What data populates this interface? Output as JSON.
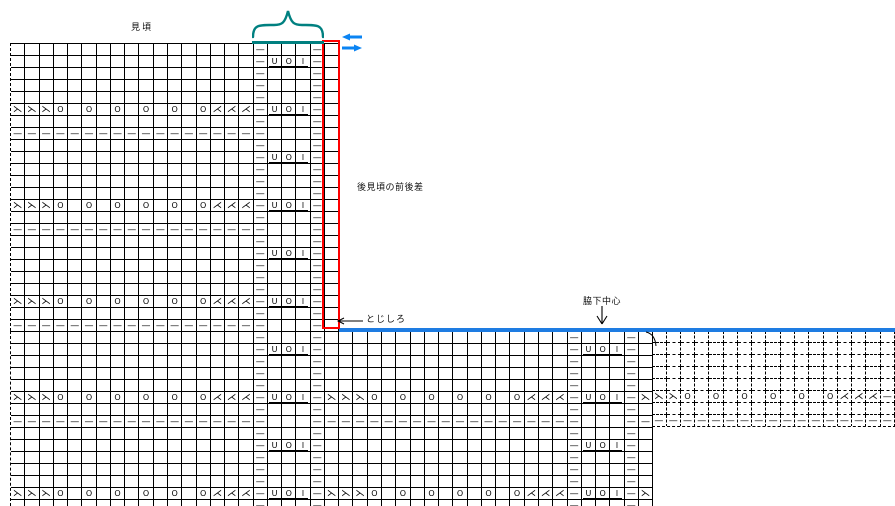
{
  "labels": {
    "migoro": "見頃",
    "back_difference": "後見頃の前後差",
    "tojishiro": "とじしろ",
    "wakishita_chushin": "脇下中心"
  },
  "colors": {
    "grid": "#000000",
    "red_band": "#FF0000",
    "blue_line": "#1E7CE2",
    "teal_brace": "#008080",
    "arrow_blue": "#0B84F3",
    "background": "#FFFFFF"
  },
  "symbols": {
    "ssk": "⋋",
    "k2tog": "⋌",
    "yo": "O",
    "purl": "—",
    "u": "U",
    "i": "I"
  },
  "chart": {
    "type": "knitting-chart",
    "repeat": [
      "ssk",
      "ssk",
      "ssk",
      "yo",
      "",
      "yo",
      "",
      "yo",
      "",
      "yo",
      "",
      "yo",
      "",
      "yo",
      "k2tog",
      "k2tog",
      "k2tog",
      "purl",
      "u",
      "yo",
      "i",
      "purl"
    ],
    "row_cycle": [
      "lace",
      "sparse",
      "dash",
      "sparse",
      "uoi",
      "sparse",
      "sparse",
      "sparse"
    ],
    "row_cycle_offset": 3,
    "cell": {
      "w": 14.27,
      "h": 12
    },
    "grids": {
      "upper": {
        "x": 10,
        "y": 43,
        "rows": 24,
        "cols": 23,
        "red_col": 22
      },
      "lower": {
        "x": 10,
        "y": 331,
        "rows": 15,
        "cols": 45,
        "clip": 175
      },
      "dashed": {
        "x": 652.3,
        "y": 331,
        "rows": 8,
        "cols": 17
      }
    }
  }
}
